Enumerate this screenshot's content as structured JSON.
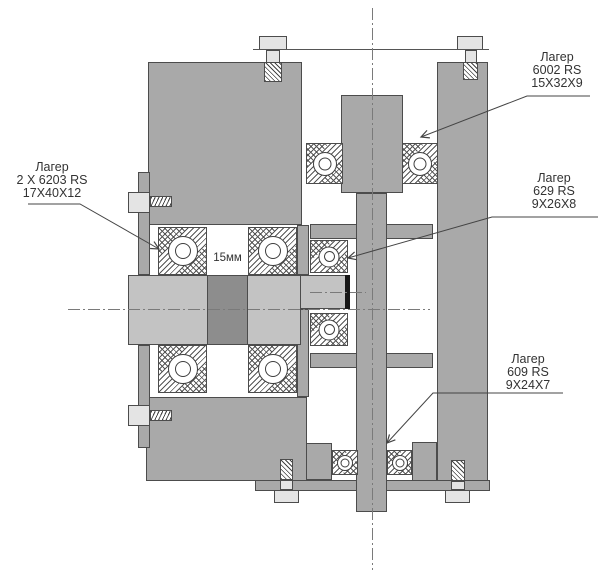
{
  "drawing": {
    "title": "Bearing assembly section",
    "dimension_label": "15мм",
    "bearings": [
      {
        "id": "6203",
        "name": "Лагер",
        "model": "2 X 6203 RS",
        "dims": "17X40X12"
      },
      {
        "id": "6002",
        "name": "Лагер",
        "model": "6002 RS",
        "dims": "15X32X9"
      },
      {
        "id": "629",
        "name": "Лагер",
        "model": "629 RS",
        "dims": "9X26X8"
      },
      {
        "id": "609",
        "name": "Лагер",
        "model": "609 RS",
        "dims": "9X24X7"
      }
    ],
    "colors": {
      "background": "#ffffff",
      "housing": "#a9a9a9",
      "shaft": "#c3c3c3",
      "spacer": "#8d8d8d",
      "fastener_head": "#e4e4e4",
      "outline": "#4c4c4c",
      "hatch": "#555555",
      "centerline": "#7a7a7a",
      "leader": "#444444",
      "text": "#333333",
      "shaft_end": "#161616"
    }
  }
}
